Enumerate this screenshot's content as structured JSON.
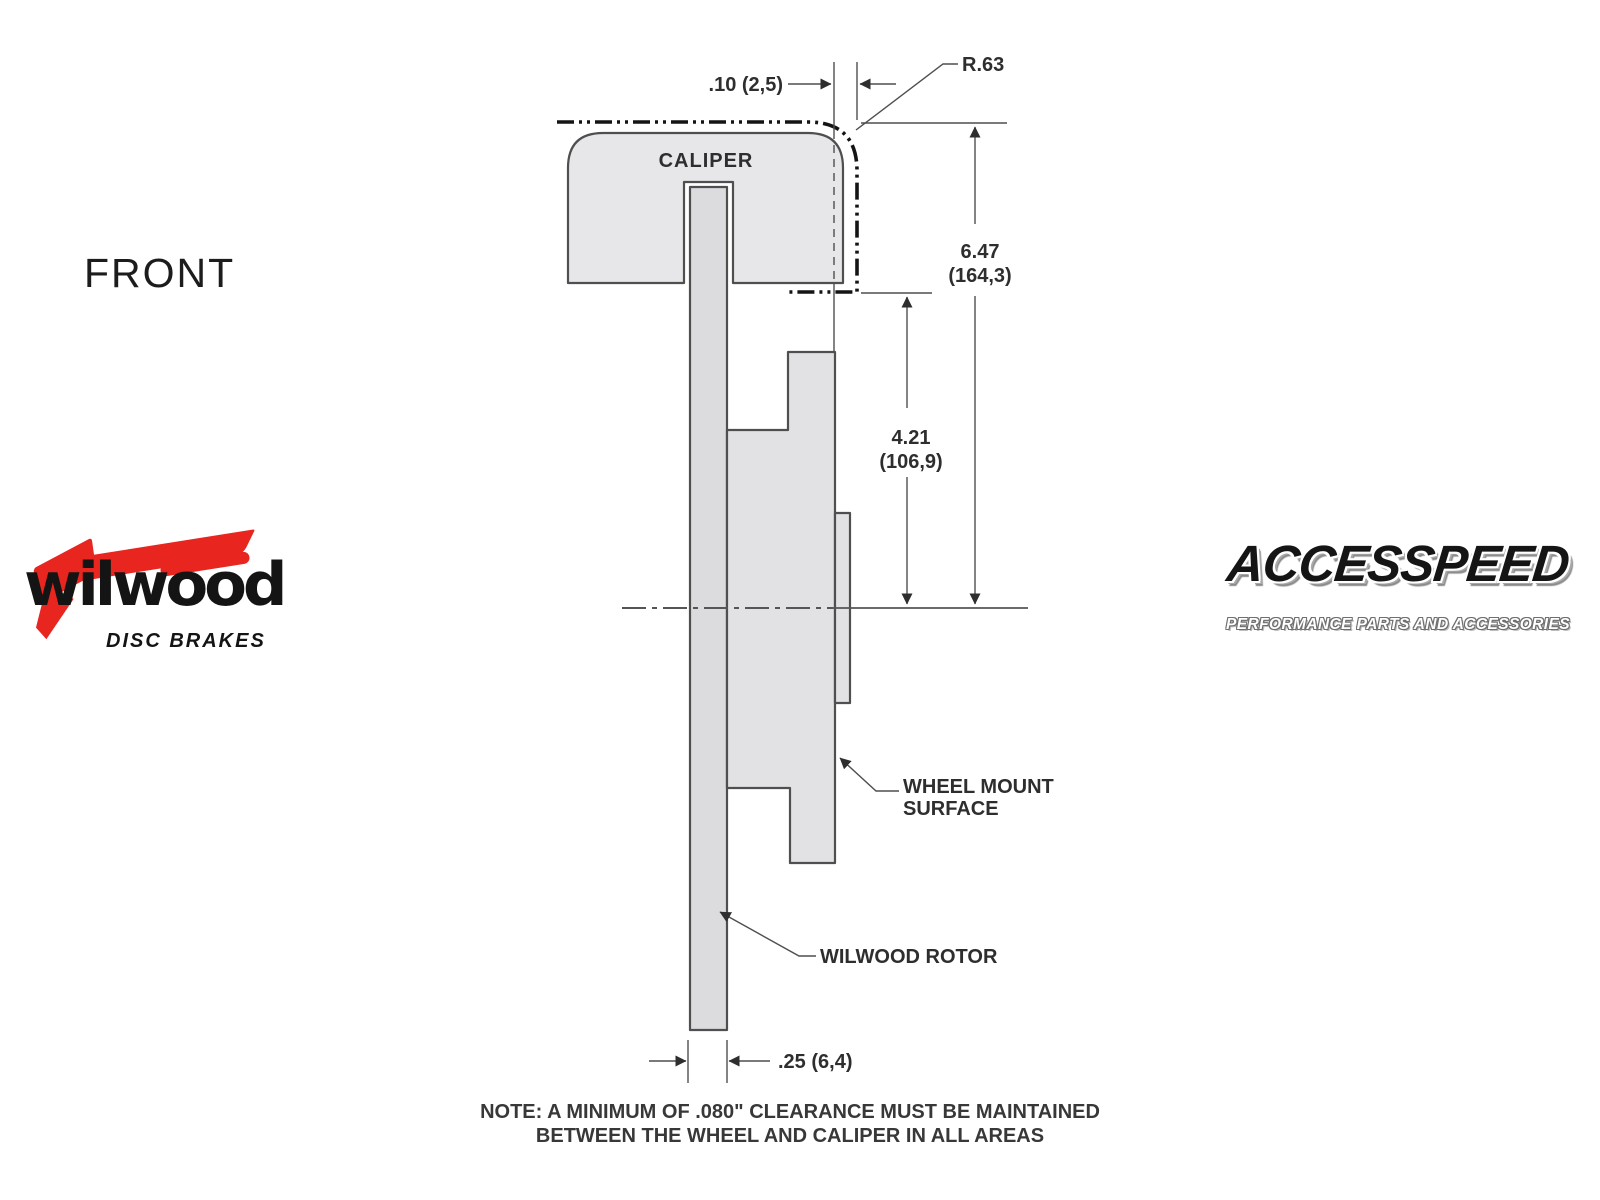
{
  "page": {
    "background": "#ffffff"
  },
  "front_label": "FRONT",
  "diagram": {
    "caliper_label": "CALIPER",
    "dims": {
      "caliper_wheel_clearance": ".10 (2,5)",
      "corner_radius": "R.63",
      "overall_height_in": "6.47",
      "overall_height_mm": "(164,3)",
      "mount_to_center_in": "4.21",
      "mount_to_center_mm": "(106,9)",
      "rotor_width": ".25 (6,4)"
    },
    "labels": {
      "wheel_mount_line1": "WHEEL MOUNT",
      "wheel_mount_line2": "SURFACE",
      "rotor": "WILWOOD ROTOR"
    },
    "note_line1": "NOTE: A MINIMUM OF .080\" CLEARANCE MUST BE MAINTAINED",
    "note_line2": "BETWEEN THE WHEEL AND CALIPER IN ALL AREAS",
    "colors": {
      "caliper_fill": "#e7e7e9",
      "rotor_fill": "#dcdcdf",
      "hat_fill": "#e2e2e4",
      "outline": "#4f4f4f",
      "phantom_line": "#141414",
      "text": "#2e2e2e"
    }
  },
  "logos": {
    "wilwood": {
      "name": "wilwood",
      "tagline": "DISC BRAKES",
      "accent": "#e8251f"
    },
    "accesspeed": {
      "name": "ACCESSPEED",
      "tagline": "PERFORMANCE PARTS AND ACCESSORIES"
    }
  }
}
